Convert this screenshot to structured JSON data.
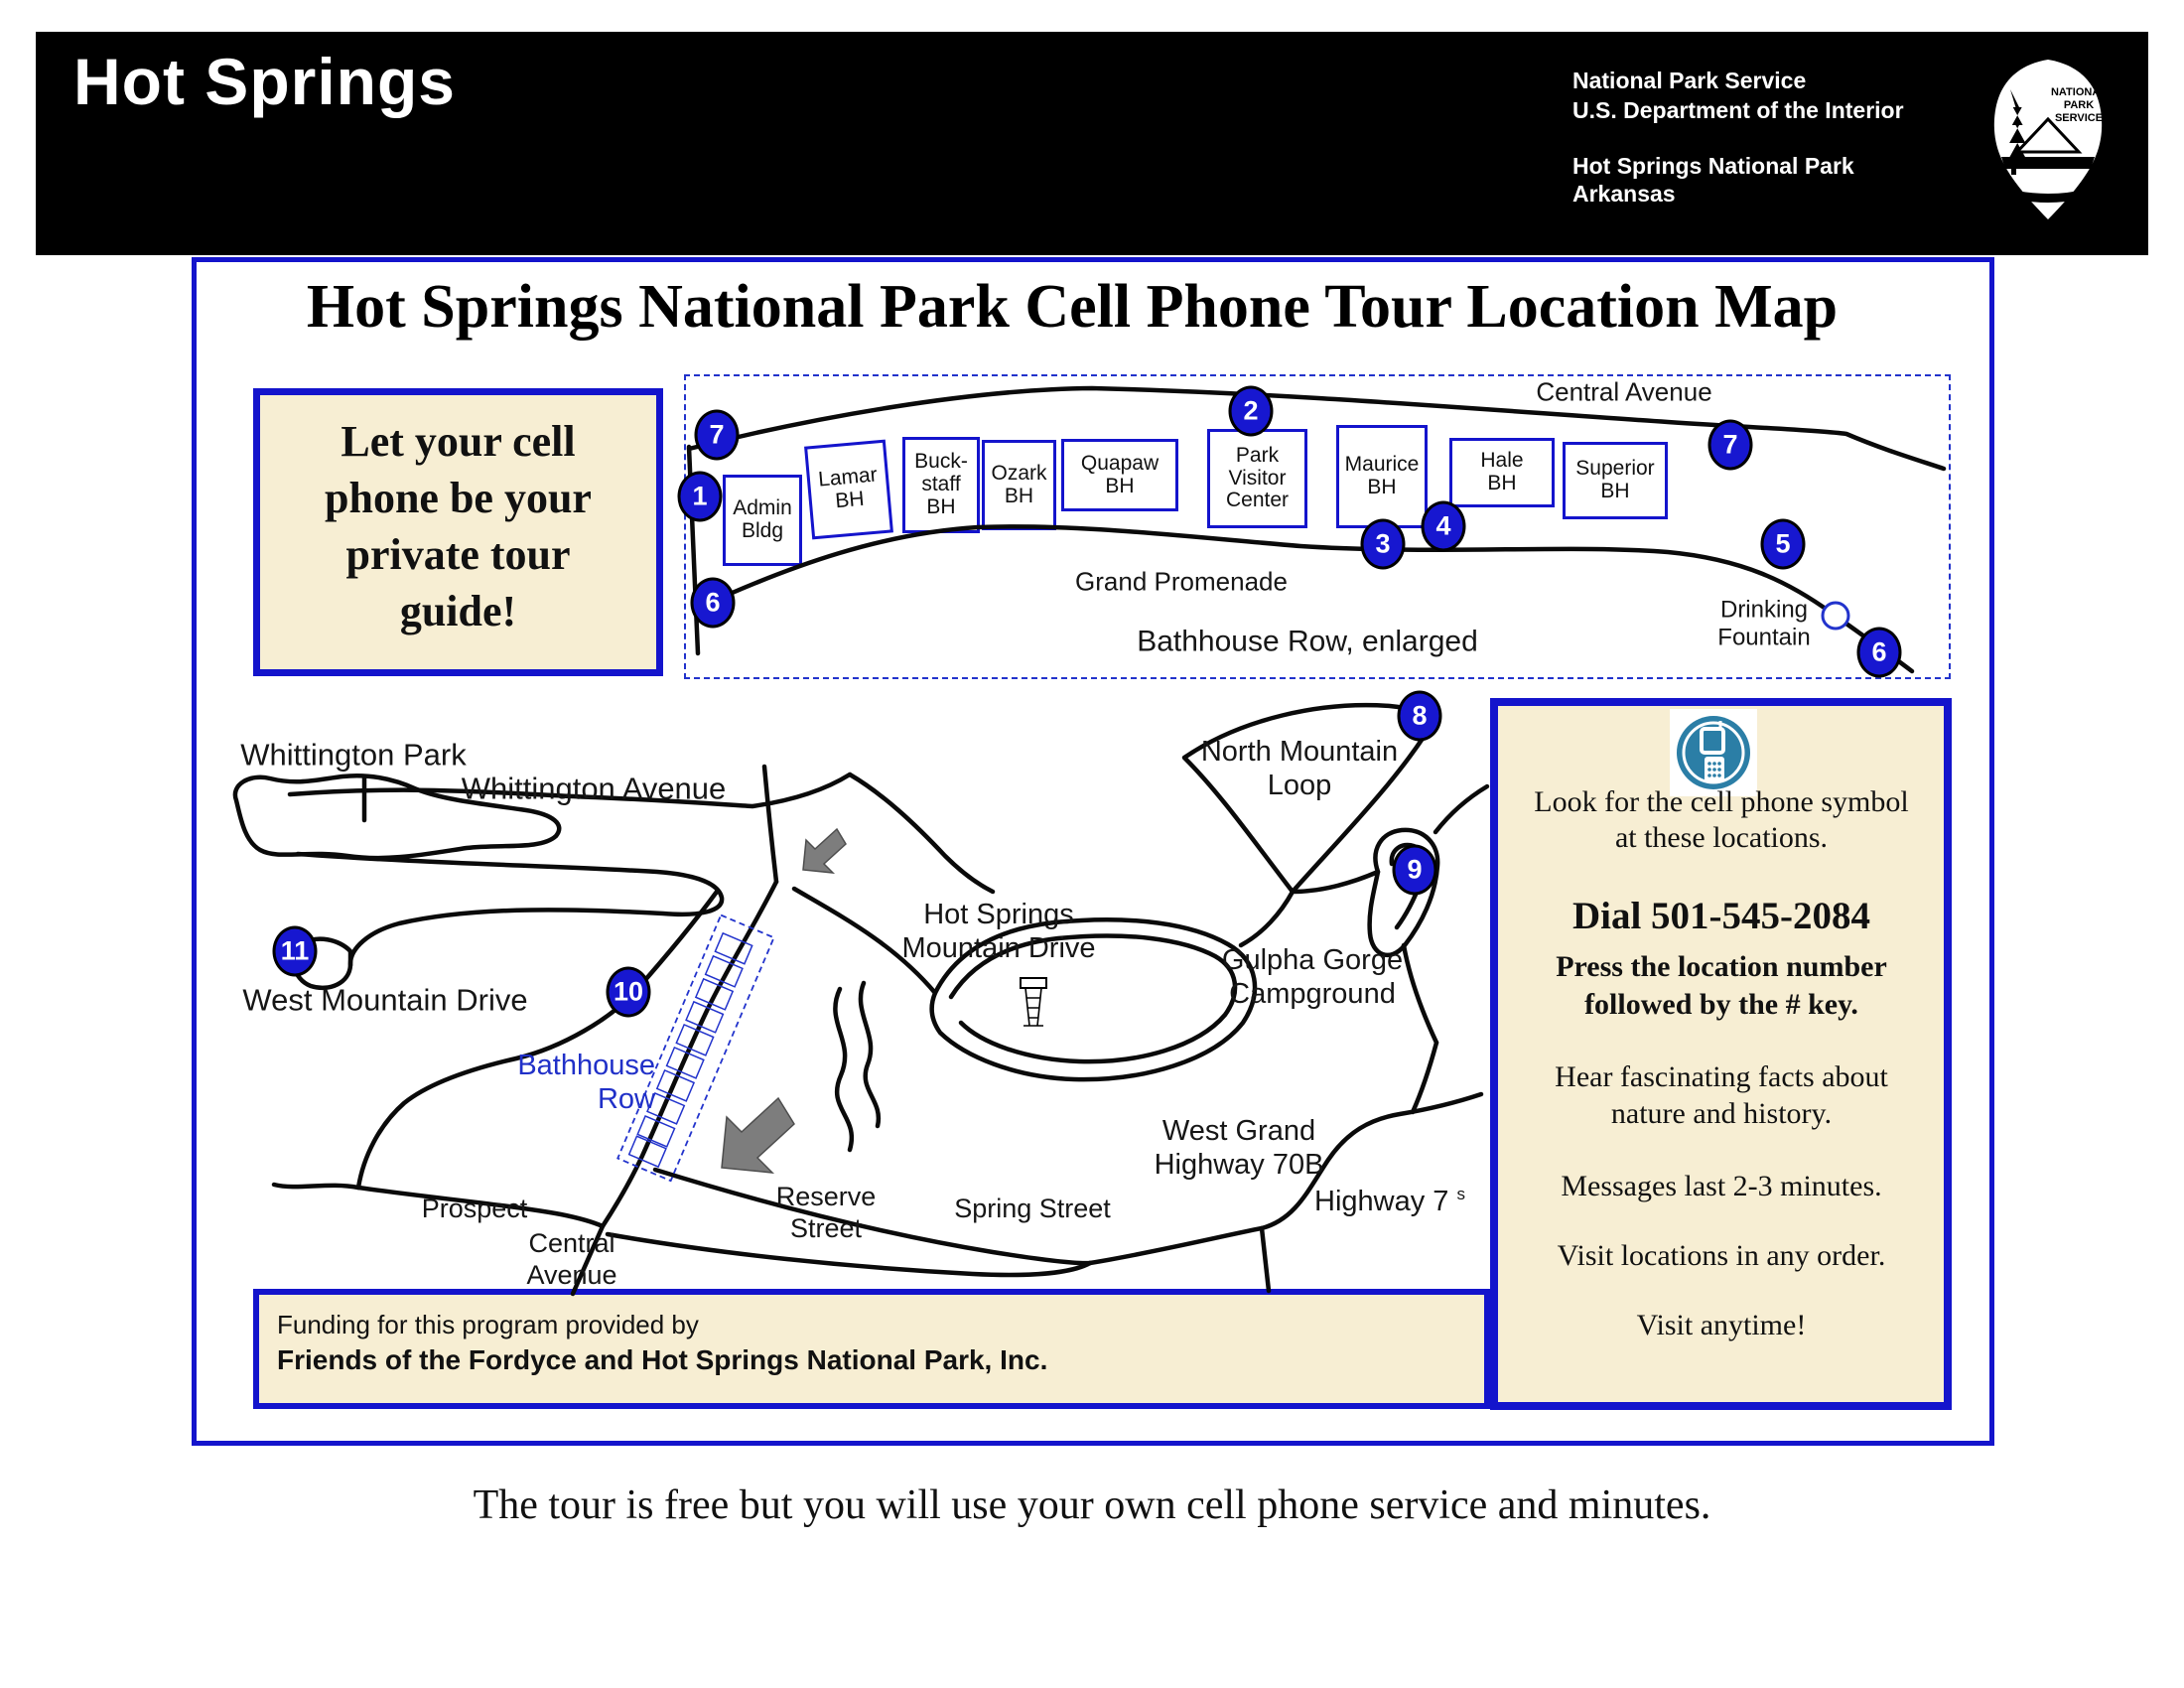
{
  "header": {
    "park_title": "Hot Springs",
    "agency_line1": "National Park Service",
    "agency_line2": "U.S. Department of the Interior",
    "park_line1": "Hot Springs National Park",
    "park_line2": "Arkansas",
    "logo_text": "NATIONAL\nPARK\nSERVICE"
  },
  "page": {
    "map_title": "Hot Springs National Park Cell Phone Tour Location Map",
    "promo": "Let your cell\nphone be your\nprivate tour\nguide!",
    "bottom_note": "The tour is free but you will use your own cell phone service and minutes."
  },
  "enlarged": {
    "street_label": "Central Avenue",
    "promenade_label": "Grand Promenade",
    "caption": "Bathhouse Row, enlarged",
    "fountain_label": "Drinking\nFountain",
    "bathhouses": [
      {
        "name": "Admin\nBldg"
      },
      {
        "name": "Lamar\nBH"
      },
      {
        "name": "Buck-\nstaff\nBH"
      },
      {
        "name": "Ozark\nBH"
      },
      {
        "name": "Quapaw\nBH"
      },
      {
        "name": "Park\nVisitor\nCenter"
      },
      {
        "name": "Maurice\nBH"
      },
      {
        "name": "Hale\nBH"
      },
      {
        "name": "Superior\nBH"
      }
    ],
    "markers": [
      "7",
      "1",
      "6",
      "2",
      "3",
      "4",
      "5",
      "7",
      "6"
    ]
  },
  "main_map": {
    "labels": {
      "whittington_park": "Whittington Park",
      "whittington_avenue": "Whittington Avenue",
      "west_mountain_drive": "West Mountain Drive",
      "bathhouse_row": "Bathhouse\nRow",
      "hot_springs_mountain_drive": "Hot Springs\nMountain Drive",
      "north_mountain_loop": "North Mountain\nLoop",
      "gulpha_gorge": "Gulpha Gorge\nCampground",
      "west_grand": "West Grand\nHighway 70B",
      "highway7": "Highway 7",
      "highway7_sup": "s",
      "prospect": "Prospect",
      "central_avenue": "Central\nAvenue",
      "reserve_street": "Reserve\nStreet",
      "spring_street": "Spring Street"
    },
    "markers": [
      "8",
      "9",
      "10",
      "11"
    ]
  },
  "info_box": {
    "look": "Look for the cell phone symbol\nat these locations.",
    "dial": "Dial 501-545-2084",
    "press": "Press the location number\nfollowed by the # key.",
    "hear": "Hear fascinating facts about\nnature and history.",
    "messages": "Messages last 2-3 minutes.",
    "any_order": "Visit locations in any order.",
    "anytime": "Visit anytime!"
  },
  "funding": {
    "line1": "Funding for this program provided by",
    "line2": "Friends of the Fordyce and Hot Springs National Park, Inc."
  },
  "colors": {
    "accent_blue": "#1414cc",
    "marker_blue": "#1717d0",
    "cream": "#f7eed3",
    "icon_teal": "#2b7ea6"
  }
}
